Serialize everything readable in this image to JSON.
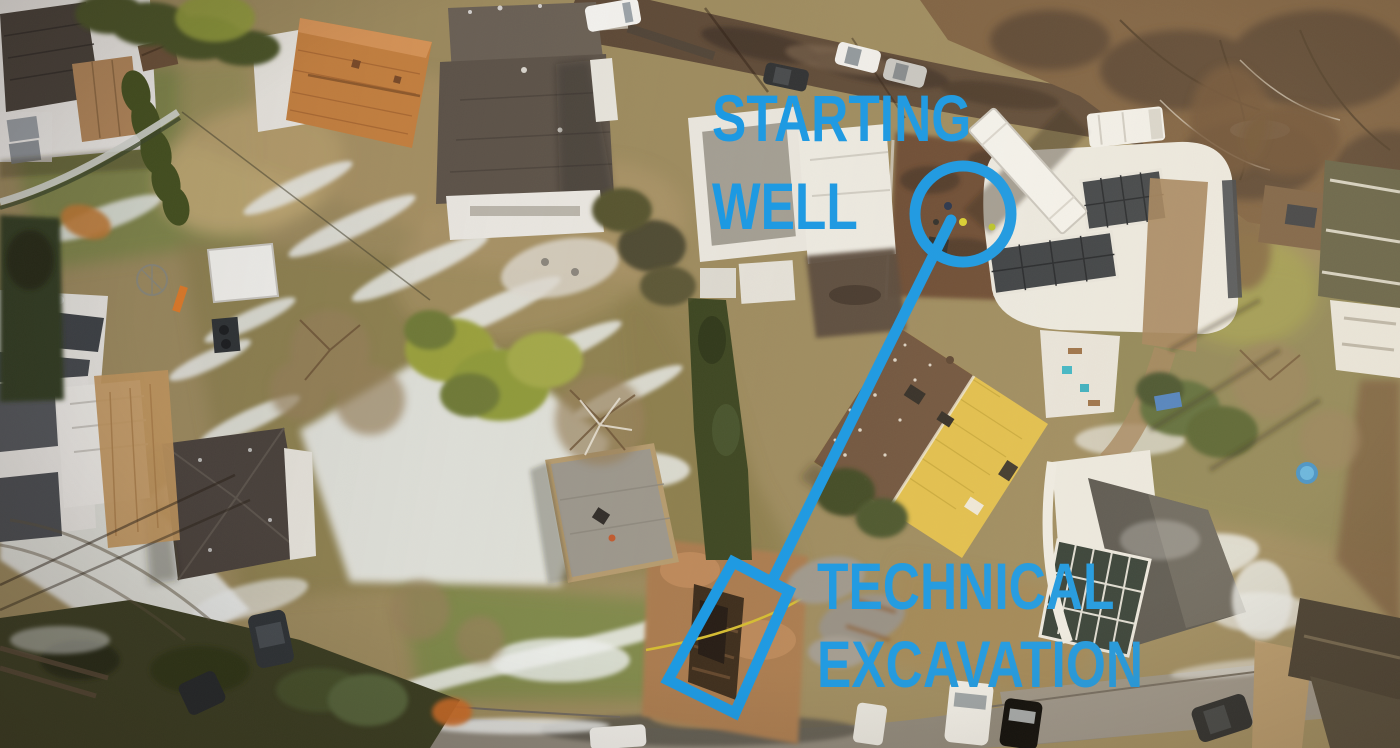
{
  "annotations": {
    "color": "#1697E4",
    "labels": {
      "starting_well": {
        "line1": "STARTING",
        "line2": "WELL"
      },
      "technical_excavation": {
        "line1": "TECHNICAL",
        "line2": "EXCAVATION"
      }
    },
    "markers": {
      "well_circle": {
        "cx": "963",
        "cy": "214",
        "r": "48",
        "stroke_width": "11"
      },
      "route_line": {
        "x1": "951",
        "y1": "220",
        "x2": "774",
        "y2": "577",
        "stroke_width": "11"
      },
      "excavation_box": {
        "points": "733,562 789,591 735,713 668,680",
        "stroke_width": "11"
      }
    }
  },
  "scene": {
    "kind": "winter aerial drone photo of a suburban neighborhood",
    "visible_elements": [
      "starting well dig area with workers, equipment and white truck trailer by the upper road",
      "open brown trench of the technical excavation near the lower road",
      "houses with white, taupe, terracotta, yellow and dark roofs",
      "gardens with patchy snow, hedges, evergreens and bare trees",
      "roads with parked cars at top and bottom"
    ]
  }
}
